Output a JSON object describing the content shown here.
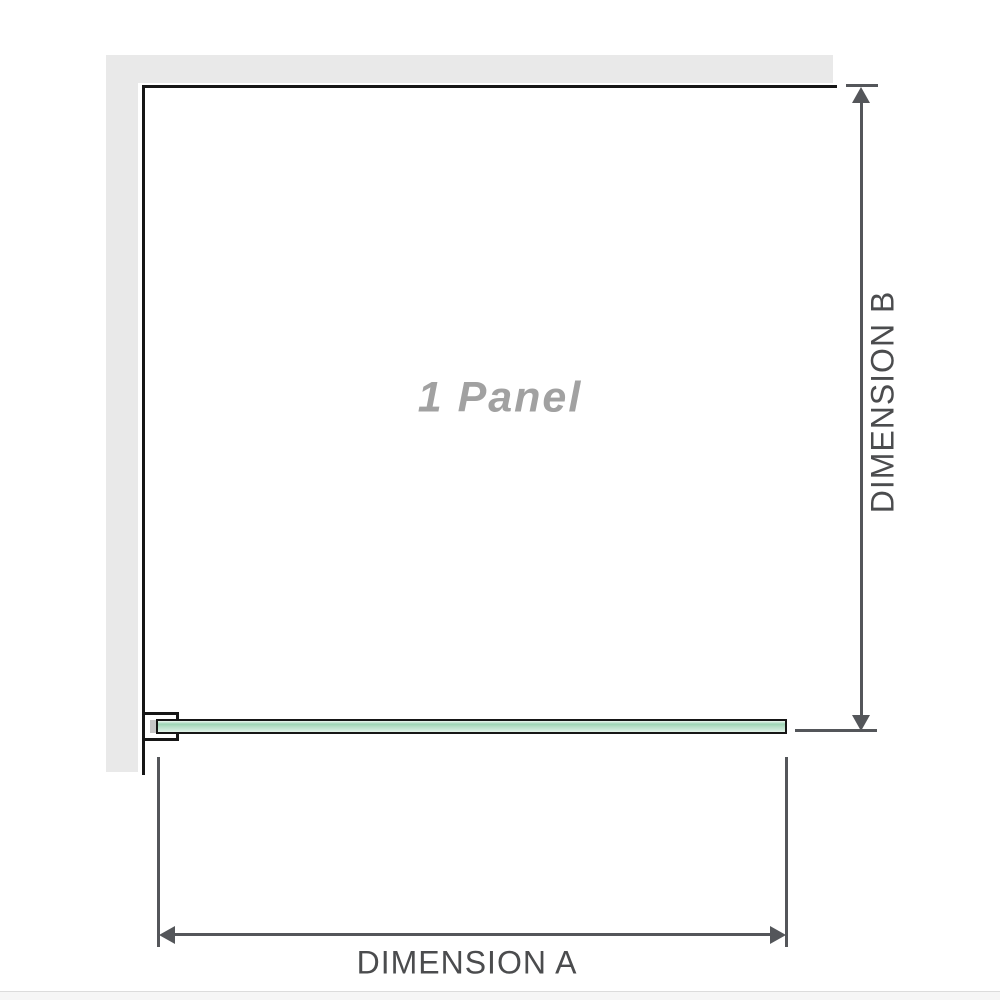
{
  "diagram": {
    "panel_label": "1 Panel",
    "dimension_a_label": "DIMENSION A",
    "dimension_b_label": "DIMENSION B",
    "colors": {
      "glass_green": "#b9e0c9",
      "wall_gray": "#e9e9e9",
      "outline": "#161616",
      "dimension_line": "#54565a",
      "dimension_text": "#4b4c4e",
      "label_gray": "#a1a1a1"
    }
  }
}
